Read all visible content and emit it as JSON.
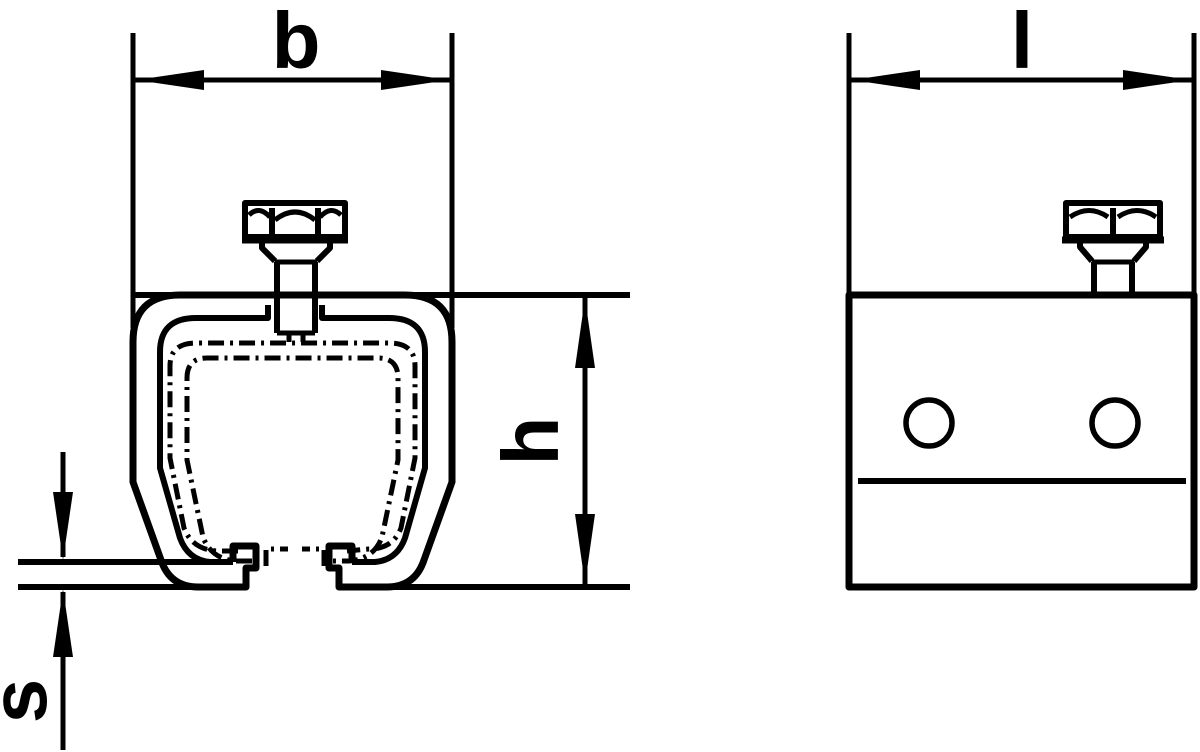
{
  "drawing": {
    "type": "technical-drawing",
    "colors": {
      "line": "#000000",
      "background": "#ffffff"
    },
    "front_view": {
      "description": "c-rail-profile-cross-section-with-hex-bolt",
      "labels": {
        "width": "b",
        "height": "h",
        "thickness": "s"
      }
    },
    "side_view": {
      "description": "rail-clamp-side-elevation-with-hex-bolt-and-holes",
      "labels": {
        "length": "l"
      }
    }
  }
}
